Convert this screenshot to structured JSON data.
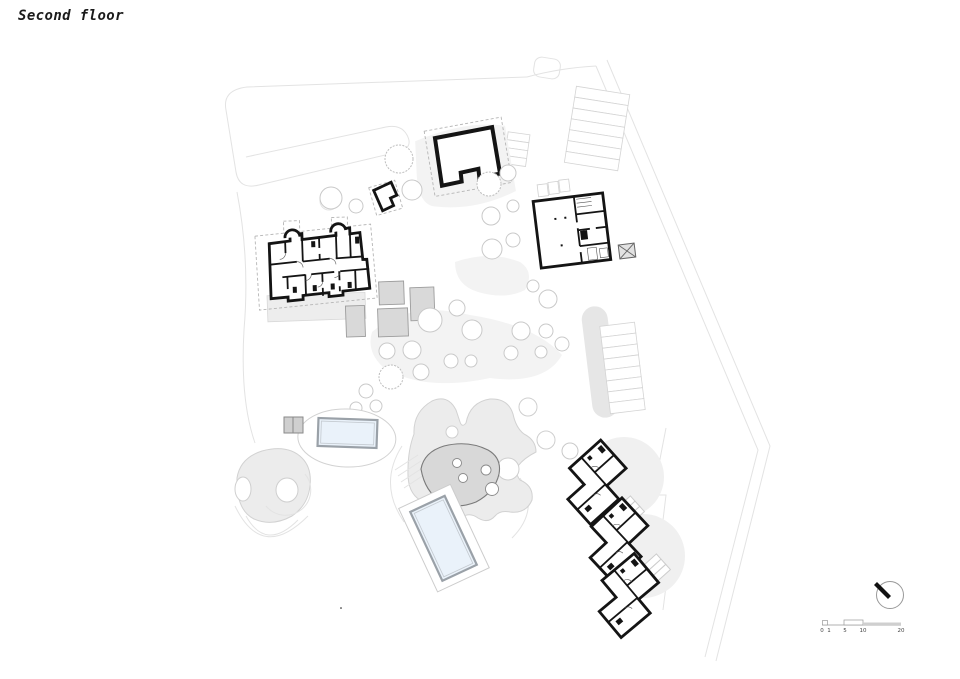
{
  "page": {
    "title": "Second floor"
  },
  "scale_bar": {
    "labels": [
      "0",
      "1",
      "5",
      "10",
      "20"
    ]
  },
  "compass": {
    "icon": "north-arrow-icon"
  },
  "colors": {
    "wall_black": "#141414",
    "ground_light": "#ececec",
    "ground_mid": "#d8d8d8",
    "pool_water": "#eaf2fa",
    "pool_frame": "#9aa1a8",
    "tree_stroke": "#c9c9c9",
    "dashed_boundary": "#b5b5b5",
    "faint_outline": "#e3e3e3"
  }
}
